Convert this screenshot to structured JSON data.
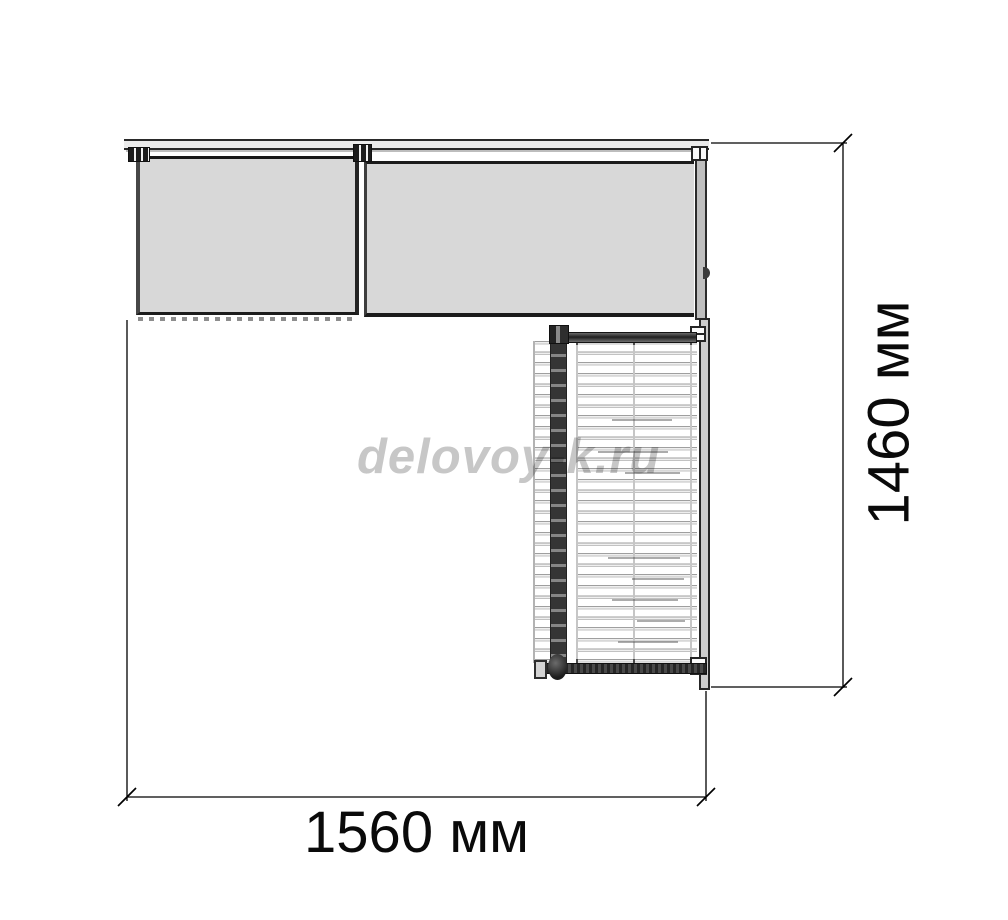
{
  "page": {
    "background": "#ffffff",
    "type": "furniture-dimension-diagram"
  },
  "watermark": {
    "text": "delovoy-k.ru",
    "color": "#c7c7c7"
  },
  "dimensions": {
    "width": {
      "label": "1560 мм",
      "value_mm": 1560
    },
    "height": {
      "label": "1460 мм",
      "value_mm": 1460
    }
  },
  "drawing": {
    "colors": {
      "panel_fill": "#d8d8d8",
      "panel_edge_dark": "#1f1f1f",
      "tabletop_fill": "#ececec",
      "wire_light": "#c6c6c6",
      "rail_dark": "#2e2e2e",
      "dimension_line": "#000000",
      "label_text": "#0a0a0a"
    }
  }
}
